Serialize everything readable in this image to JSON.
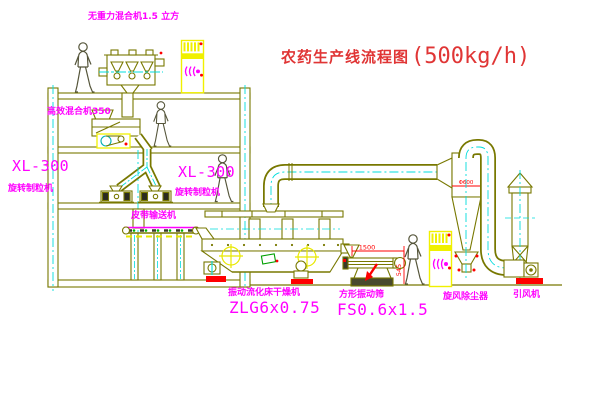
{
  "title": {
    "name": "农药生产线流程图",
    "capacity": "(500kg/h)"
  },
  "equipment_labels": {
    "weightless_mixer": "无重力混合机1.5 立方",
    "high_efficiency_mixer": "高效混合机350",
    "granulator_left_model": "XL-300",
    "granulator_left_name": "旋转制粒机",
    "granulator_center_model": "XL-300",
    "granulator_center_name": "旋转制粒机",
    "belt_conveyor": "皮带输送机",
    "dryer_name": "振动流化床干燥机",
    "dryer_model": "ZLG6x0.75",
    "sieve_name": "方形振动筛",
    "sieve_model": "FS0.6x1.5",
    "cyclone_name": "旋风除尘器",
    "fan_name": "引风机"
  },
  "dimensions": {
    "sieve_length": "1500",
    "sieve_height": "545",
    "cyclone_note": "Φ600"
  },
  "colors": {
    "line": "#787800",
    "label_text": "#ff00ff",
    "title_text": "#e03535",
    "highlight": "#f0f000",
    "accent": "#ff0000",
    "centerline": "#00dcdc",
    "belt_dot": "#00b000"
  }
}
